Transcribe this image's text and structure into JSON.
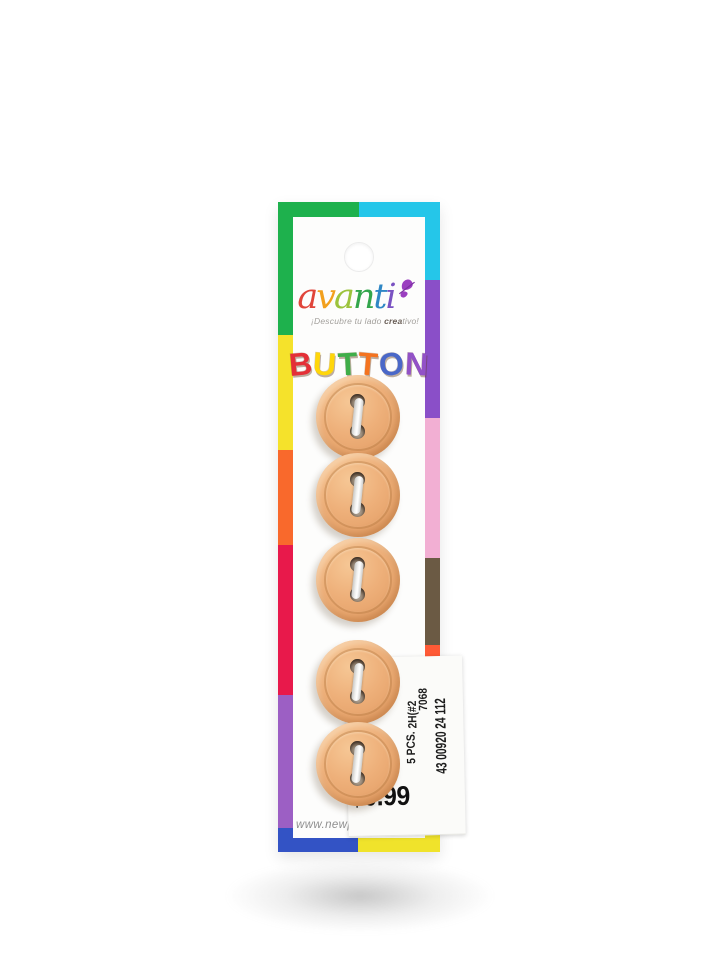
{
  "page": {
    "type": "product-photo",
    "background": "#ffffff"
  },
  "brand": {
    "name": "avanti",
    "letters": [
      {
        "ch": "a",
        "color": "#e0453a"
      },
      {
        "ch": "v",
        "color": "#f2a01d"
      },
      {
        "ch": "a",
        "color": "#9cc33c"
      },
      {
        "ch": "n",
        "color": "#33a64c"
      },
      {
        "ch": "t",
        "color": "#2f87c5"
      },
      {
        "ch": "i",
        "color": "#7a52c2"
      }
    ],
    "butterfly_color": "#9b3fc0",
    "tagline": {
      "prefix": "¡Descubre tu lado ",
      "bold": "crea",
      "suffix": "tivo!"
    }
  },
  "title": {
    "text": "BUTTONS",
    "letters": [
      {
        "ch": "B",
        "color": "#e43037"
      },
      {
        "ch": "U",
        "color": "#ffd60a"
      },
      {
        "ch": "T",
        "color": "#3fae49"
      },
      {
        "ch": "T",
        "color": "#f4731f"
      },
      {
        "ch": "O",
        "color": "#4a68c8"
      },
      {
        "ch": "N",
        "color": "#9252c7"
      },
      {
        "ch": "S",
        "color": "#e876c9"
      }
    ]
  },
  "product": {
    "item": "sew-through buttons",
    "count": 5,
    "visible_holes_per_button": 2,
    "button_color": "#eda974",
    "thread_color": "#efefef"
  },
  "sticker": {
    "code": "2H(#2",
    "style_number": "7068",
    "quantity": "5 PCS.",
    "barcode_number": "43 00920 24 112",
    "price": "$0.99"
  },
  "footer": {
    "website": "www.newports"
  },
  "card": {
    "border_colors": {
      "top": [
        "#1eb14d",
        "#25c6e9"
      ],
      "bottom": [
        "#3353c5",
        "#f0e32b"
      ],
      "left": [
        "#1eb14d",
        "#f5e22b",
        "#f9692c",
        "#e8194b",
        "#9c5fc4",
        "#3353c5"
      ],
      "right": [
        "#25c6e9",
        "#8a4fc8",
        "#f2afd3",
        "#6b5a44",
        "#ff5a36",
        "#f0e32b"
      ]
    }
  }
}
